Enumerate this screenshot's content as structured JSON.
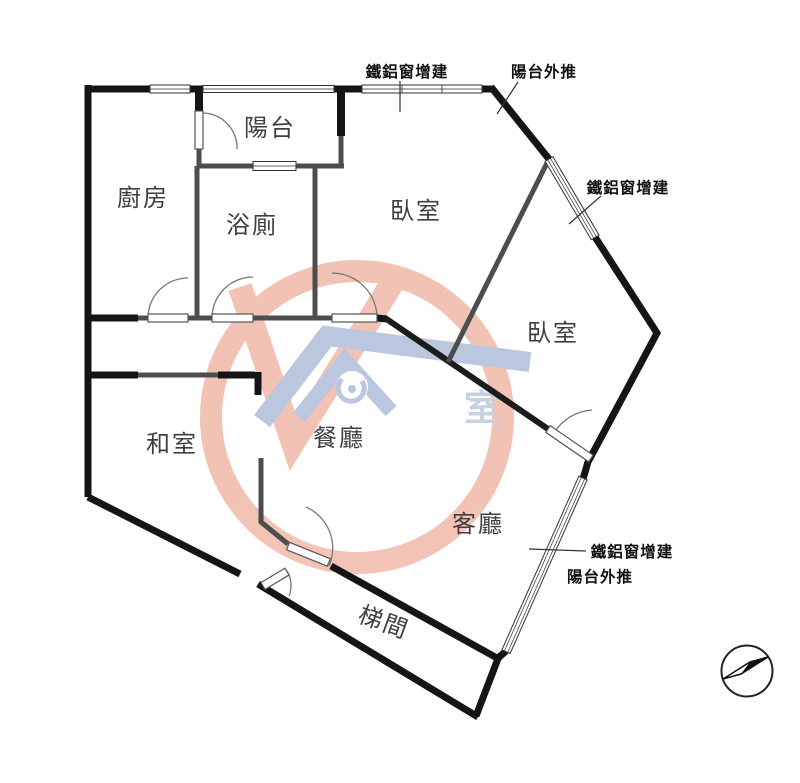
{
  "floorplan": {
    "rooms": [
      {
        "id": "balcony",
        "label": "陽台"
      },
      {
        "id": "kitchen",
        "label": "廚房"
      },
      {
        "id": "bathroom",
        "label": "浴廁"
      },
      {
        "id": "bedroom-1",
        "label": "臥室"
      },
      {
        "id": "bedroom-2",
        "label": "臥室"
      },
      {
        "id": "tatami-room",
        "label": "和室"
      },
      {
        "id": "dining-room",
        "label": "餐廳"
      },
      {
        "id": "living-room",
        "label": "客廳"
      },
      {
        "id": "stairwell",
        "label": "梯間"
      }
    ],
    "annotations": [
      {
        "id": "top-window-addition",
        "label": "鐵鋁窗增建"
      },
      {
        "id": "top-balcony-pushout",
        "label": "陽台外推"
      },
      {
        "id": "right-window-addition",
        "label": "鐵鋁窗增建"
      },
      {
        "id": "bottom-window-addition",
        "label": "鐵鋁窗增建"
      },
      {
        "id": "bottom-balcony-pushout",
        "label": "陽台外推"
      }
    ],
    "watermark": {
      "text": "室",
      "ring_color": "#f0b4a2",
      "roof_color": "#a9bad7"
    },
    "colors": {
      "exterior_wall": "#151515",
      "interior_wall": "#4d4d4d",
      "room_label": "#3f3f3f",
      "annotation_text": "#111111"
    },
    "compass": {
      "id": "north-arrow"
    }
  }
}
